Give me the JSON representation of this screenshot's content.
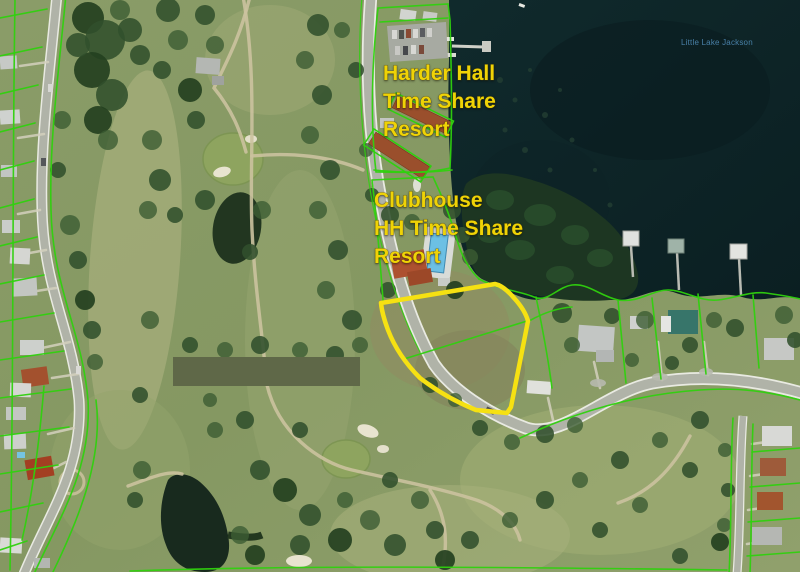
{
  "map": {
    "annotations": {
      "resort": {
        "line1": "Harder Hall",
        "line2": "Time Share",
        "line3": "Resort"
      },
      "clubhouse": {
        "line1": "Clubhouse",
        "line2": "HH Time Share",
        "line3": "Resort"
      },
      "lake_name": "Little Lake Jackson"
    },
    "colors": {
      "annotation_yellow": "#efd306",
      "lake_label_blue": "#4c85ae",
      "parcel_green": "#2fd10e",
      "highlight_yellow": "#f6e112",
      "redaction_olive": "#5f6848"
    }
  }
}
